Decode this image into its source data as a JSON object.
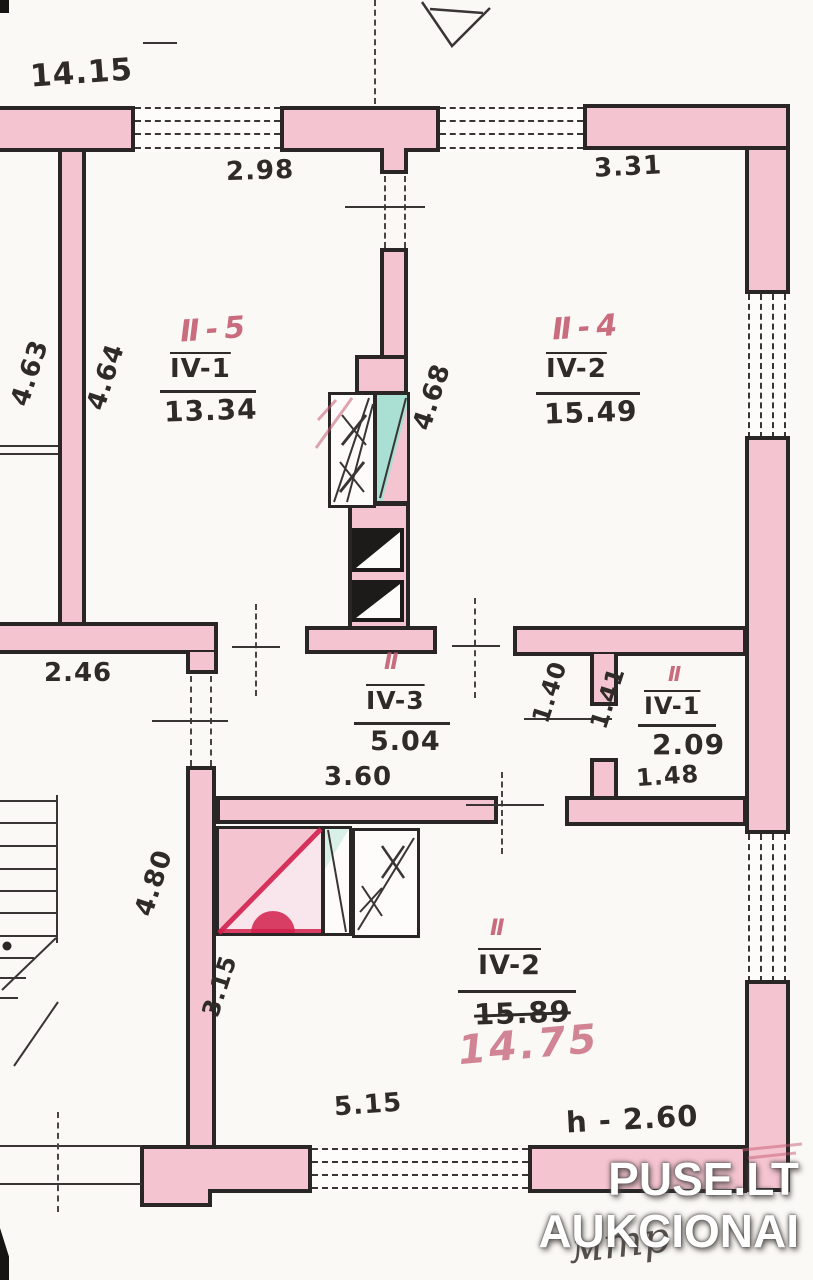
{
  "plan": {
    "dimensions": {
      "top_left": "14.15",
      "top_room5": "2.98",
      "top_room4": "3.31",
      "left_outer": "4.63",
      "left_inner": "4.64",
      "shaft": "4.68",
      "hall_left": "2.46",
      "corridor_width": "3.60",
      "wc_w1": "1.40",
      "wc_w2": "1.41",
      "wc_bottom": "1.48",
      "big_left_upper": "4.80",
      "big_left_lower": "3.15",
      "big_bottom": "5.15",
      "ceiling_height": "h - 2.60"
    },
    "rooms": {
      "room5": {
        "red_label": "Ⅱ-5",
        "number": "IV-1",
        "area": "13.34"
      },
      "room4": {
        "red_label": "Ⅱ-4",
        "number": "IV-2",
        "area": "15.49"
      },
      "corridor": {
        "red_label": "Ⅱ",
        "number": "IV-3",
        "area": "5.04"
      },
      "wc": {
        "red_label": "Ⅱ",
        "number": "IV-1",
        "area": "2.09"
      },
      "big_room": {
        "red_label": "Ⅱ",
        "number": "IV-2",
        "area_old": "15.89",
        "area_new": "14.75"
      }
    },
    "annotations": {
      "handwriting": "мтр"
    },
    "watermark": {
      "line1": "PUSE.LT",
      "line2": "AUKCIONAI"
    },
    "colors": {
      "wall_pink": "#f5c4d1",
      "teal": "#aadfd4",
      "ink": "#2a2626",
      "red_pencil": "#c45d72",
      "red_mark": "#d2204c"
    }
  }
}
